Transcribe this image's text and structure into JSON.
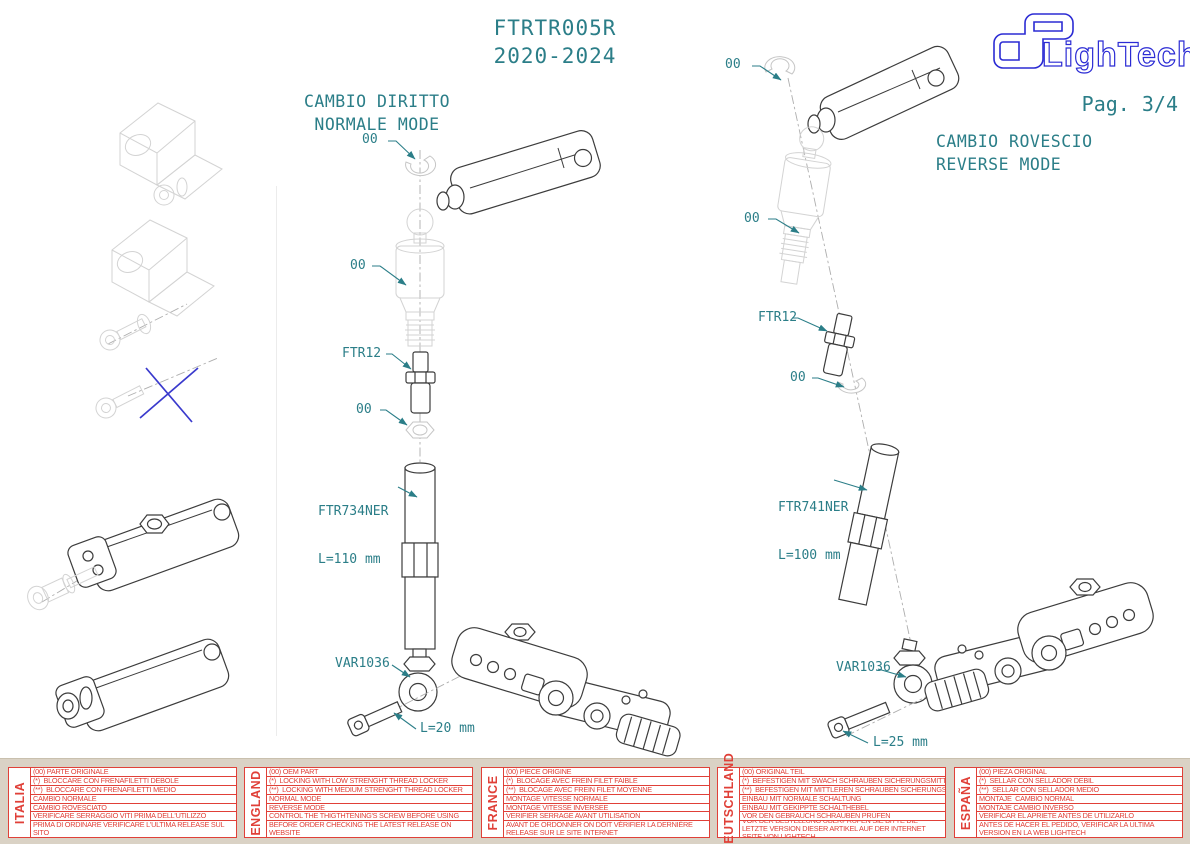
{
  "header": {
    "product_code": "FTRTR005R",
    "years": "2020-2024",
    "page_label": "Pag. 3/4",
    "brand": "LighTech"
  },
  "colors": {
    "accent_teal": "#2B7E88",
    "note_red": "#E04038",
    "logo_blue": "#2B2BD4",
    "drawing_dark": "#3C3C3C",
    "drawing_faint": "#D3D3D3",
    "table_bg": "#DAD2C5",
    "cross_blue": "#3A3ACD"
  },
  "diagram_normal": {
    "title1": "CAMBIO DIRITTO",
    "title2": "NORMALE MODE",
    "callout_clip": "00",
    "callout_actuator": "00",
    "callout_stud": "FTR12",
    "callout_nut": "00",
    "callout_rod": "FTR734NER",
    "callout_rod_len": "L=110 mm",
    "callout_rodend": "VAR1036",
    "callout_bolt_len": "L=20 mm"
  },
  "diagram_reverse": {
    "title1": "CAMBIO ROVESCIO",
    "title2": "REVERSE MODE",
    "callout_clip": "00",
    "callout_actuator": "00",
    "callout_stud": "FTR12",
    "callout_clip2": "00",
    "callout_rod": "FTR741NER",
    "callout_rod_len": "L=100 mm",
    "callout_rodend": "VAR1036",
    "callout_bolt_len": "L=25 mm"
  },
  "table": {
    "sections": [
      {
        "language": "ITALIA",
        "rows": [
          "(00) PARTE ORIGINALE",
          "(*)  BLOCCARE CON FRENAFILETTI DEBOLE",
          "(**)  BLOCCARE CON FRENAFILETTI MEDIO",
          "CAMBIO NORMALE",
          "CAMBIO ROVESCIATO",
          "VERIFICARE SERRAGGIO VITI PRIMA DELL'UTILIZZO"
        ],
        "footer": "PRIMA DI ORDINARE VERIFICARE L'ULTIMA RELEASE SUL SITO"
      },
      {
        "language": "ENGLAND",
        "rows": [
          "(00) OEM PART",
          "(*)  LOCKING WITH LOW STRENGHT THREAD LOCKER",
          "(**)  LOCKING WITH MEDIUM STRENGHT THREAD LOCKER",
          "NORMAL MODE",
          "REVERSE MODE",
          "CONTROL THE THIGTHTENING'S SCREW BEFORE USING"
        ],
        "footer": "BEFORE ORDER CHECKING THE LATEST RELEASE ON WEBSITE"
      },
      {
        "language": "FRANCE",
        "rows": [
          "(00) PIECE ORIGINE",
          "(*)  BLOCAGE AVEC FREIN FILET FAIBLE",
          "(**)  BLOCAGE AVEC FREIN FILET MOYENNE",
          "MONTAGE VITESSE NORMALE",
          "MONTAGE VITESSE INVERSEE",
          "VERIFIER SERRAGE AVANT UTILISATION"
        ],
        "footer": "AVANT DE ORDONNER ON DOIT VÉRIFIER LA DERNIÈRE RELEASE SUR LE SITE INTERNET"
      },
      {
        "language": "DEUTSCHLAND",
        "rows": [
          "(00) ORIGINAL TEIL",
          "(*)  BEFESTIGEN MIT SWACH SCHRAUBEN SICHERUNGSMITTEL",
          "(**)  BEFESTIGEN MIT MITTLEREN SCHRAUBEN SICHERUNGSMITTEL",
          "EINBAU MIT NORMALE SCHALTUNG",
          "EINBAU MIT GEKIPPTE SCHALTHEBEL",
          "VOR DEN GEBRAUCH SCHRAUBEN PRÜFEN"
        ],
        "footer": "VOR DER BESTELLUNG ÜBERPRÜFEN SIE BITTE DIE LETZTE VERSION DIESER ARTIKEL AUF DER INTERNET SEITE VON LIGHTECH"
      },
      {
        "language": "ESPAÑA",
        "rows": [
          "(00) PIEZA ORIGINAL",
          "(*)  SELLAR CON SELLADOR DEBIL",
          "(**)  SELLAR CON SELLADOR MEDIO",
          "MONTAJE  CAMBIO NORMAL",
          "MONTAJE CAMBIO INVERSO",
          "VERIFICAR EL APRIETE ANTES DE UTILIZARLO"
        ],
        "footer": "ANTES DE HACER EL PEDIDO, VERIFICAR LA ULTIMA VERSION EN LA WEB LIGHTECH"
      }
    ]
  }
}
